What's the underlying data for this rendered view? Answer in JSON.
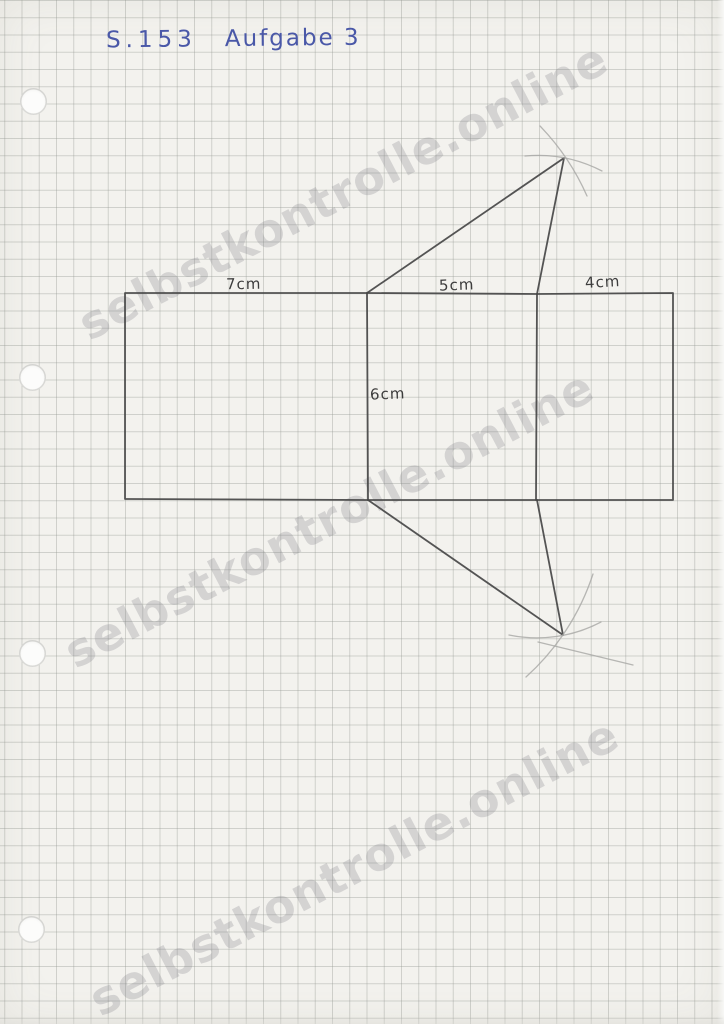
{
  "header": {
    "page_ref": "S.153",
    "task": "Aufgabe 3",
    "ink_color": "#4a58a8"
  },
  "watermark": {
    "text": "selbstkontrolle.online",
    "color": "#7c7c82",
    "angle_deg": -27.5,
    "instances": 3
  },
  "figure": {
    "description": "Hand-drawn pencil net of a triangular prism with compass construction arcs",
    "labels": {
      "left_width": "7cm",
      "middle_width": "5cm",
      "right_width": "4cm",
      "height": "6cm"
    },
    "pencil_color": "#474747",
    "construction_color": "#a6a6a4",
    "paths": {
      "outline": "M125 293 L367 293 L537 294 L673 293 L673 500 L537 500 L368 500 L125 499 Z",
      "divider_left": "M367 293 L368 500",
      "divider_right": "M537 294 L536 500",
      "triangle_top": "M367 293 L564 158 L537 294",
      "triangle_bottom": "M368 500 L563 635 L537 500",
      "arc_top_outer": "M540 126 A240 240 0 0 1 587 196",
      "arc_top_inner": "M525 156 A139 139 0 0 1 602 171",
      "arc_bottom_outer": "M593 574 A238 238 0 0 1 526 677",
      "arc_bottom_inner": "M601 622 A137 137 0 0 1 509 635",
      "stray_stroke": "M538 642 L633 665"
    }
  },
  "paper": {
    "kind_visible": "squared paper with punch holes",
    "paper_color": "#f3f2ee",
    "grid_color": "#9a9e96",
    "hole_count": 4
  }
}
